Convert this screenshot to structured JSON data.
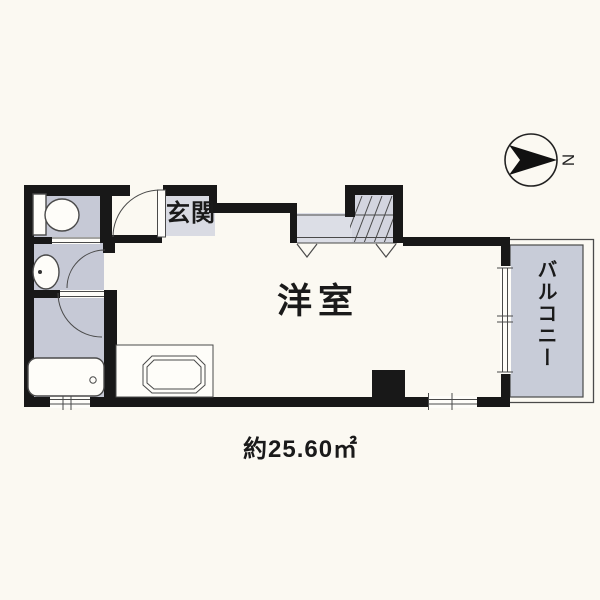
{
  "floorplan": {
    "labels": {
      "entrance": "玄関",
      "main_room": "洋室",
      "balcony": "バルコニー",
      "area": "約25.60㎡",
      "compass_north": "N"
    },
    "colors": {
      "background": "#fbf9f2",
      "wall": "#181818",
      "line": "#4a4a4a",
      "wet-floor": "#c6c9d6",
      "entrance-floor": "#d9dbe3",
      "closet-floor": "#dcdee6",
      "closet-floor-upper": "#d3d5df",
      "balcony-floor": "#c8ccd8",
      "fixture": "#fefdf9"
    },
    "fixtures": [
      "toilet",
      "washbasin",
      "bathtub",
      "kitchen-sink",
      "closet",
      "pillar",
      "compass"
    ]
  }
}
